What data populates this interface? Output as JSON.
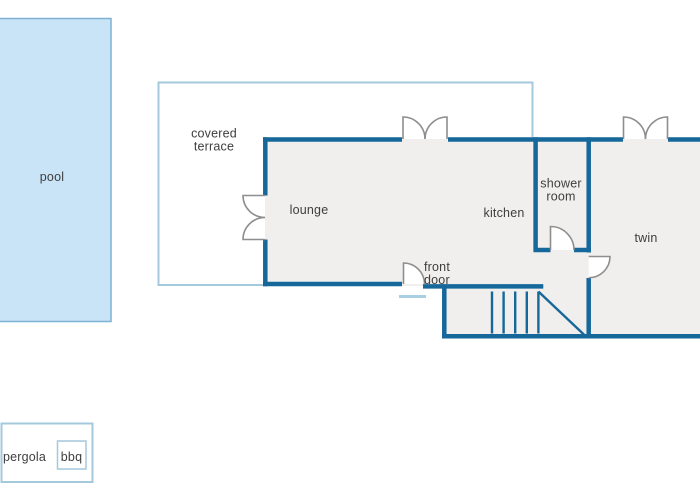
{
  "labels": {
    "pool": "pool",
    "covered_terrace": "covered terrace",
    "lounge": "lounge",
    "kitchen": "kitchen",
    "shower_room": "shower room",
    "twin": "twin",
    "front_door": "front door",
    "pergola": "pergola",
    "bbq": "bbq"
  },
  "colors": {
    "wall": "#16689b",
    "floor_fill": "#f0efee",
    "pool_fill": "#c9e4f7",
    "pool_border": "#7fb1d4",
    "outdoor_border": "#a4c9dc",
    "door_arc": "#8e8e8e",
    "doorstep": "#a9cfe3",
    "label_text": "#3e3e3e"
  }
}
